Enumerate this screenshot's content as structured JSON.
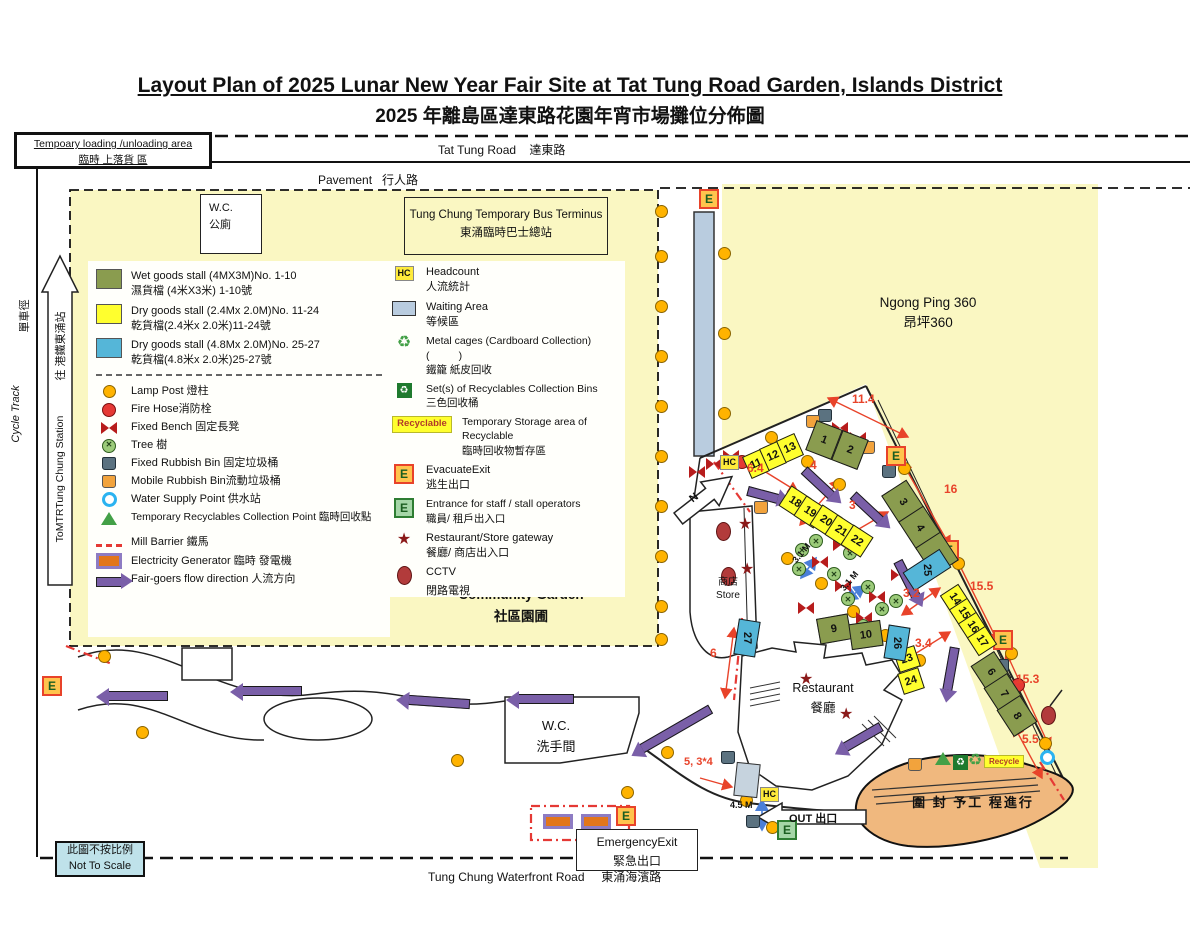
{
  "title": {
    "en": "Layout Plan of 2025 Lunar New Year Fair Site at Tat Tung Road Garden, Islands District",
    "zh": "2025 年離島區達東路花園年宵市場攤位分佈圖"
  },
  "roads": {
    "tat_tung_en": "Tat Tung Road",
    "tat_tung_zh": "達東路",
    "pavement_en": "Pavement",
    "pavement_zh": "行人路",
    "waterfront_en": "Tung Chung Waterfront Road",
    "waterfront_zh": "東涌海濱路"
  },
  "areas": {
    "loading_en": "Tempoary loading /unloading area",
    "loading_zh": "臨時 上落貨 區",
    "wc_top_en": "W.C.",
    "wc_top_zh": "公廁",
    "bus_en": "Tung Chung Temporary Bus Terminus",
    "bus_zh": "東涌臨時巴士總站",
    "ngong_en": "Ngong Ping 360",
    "ngong_zh": "昂坪360",
    "community_en": "Community Garden",
    "community_zh": "社區園圃",
    "wc_bottom_en": "W.C.",
    "wc_bottom_zh": "洗手間",
    "restaurant_en": "Restaurant",
    "restaurant_zh": "餐廳",
    "store_zh": "商店",
    "store_en": "Store",
    "emergency_en": "EmergencyExit",
    "emergency_zh": "緊急出口",
    "not_scale_zh": "此圖不按比例",
    "not_scale_en": "Not To Scale",
    "works_zh": "圍 封 予工 程進行",
    "cycle_en": "Cycle Track",
    "cycle_zh": "單車徑",
    "mtr_zh": "往 港鐵東涌站",
    "mtr_en": "ToMTRTung Chung Station"
  },
  "markers": {
    "hc": "HC",
    "e": "E",
    "out": "OUT 出口",
    "north": "N",
    "recyclable": "Recyclable",
    "recycle": "Recycle"
  },
  "legend_left": {
    "stall_types": [
      {
        "en": "Wet goods stall (4MX3M)No. 1-10",
        "zh": "濕貨檔 (4米X3米) 1-10號"
      },
      {
        "en": "Dry goods stall (2.4Mx 2.0M)No. 11-24",
        "zh": "乾貨檔(2.4米x 2.0米)11-24號"
      },
      {
        "en": "Dry goods stall (4.8Mx 2.0M)No. 25-27",
        "zh": "乾貨檔(4.8米x 2.0米)25-27號"
      }
    ],
    "items": [
      {
        "label": "Lamp Post 燈柱"
      },
      {
        "label": "Fire Hose消防栓"
      },
      {
        "label": "Fixed Bench 固定長凳"
      },
      {
        "label": "Tree 樹"
      },
      {
        "label": "Fixed Rubbish Bin 固定垃圾桶"
      },
      {
        "label": "Mobile Rubbish Bin流動垃圾桶"
      },
      {
        "label": "Water Supply Point 供水站"
      },
      {
        "label": "Temporary Recyclables Collection Point 臨時回收點"
      },
      {
        "label": "Mill Barrier  鐵馬"
      },
      {
        "label": "Electricity Generator 臨時 發電機"
      },
      {
        "label": "Fair-goers flow direction  人流方向"
      }
    ]
  },
  "legend_mid": {
    "paren": "(          )",
    "items": [
      {
        "en": "Headcount",
        "zh": "人流統計"
      },
      {
        "en": "Waiting Area",
        "zh": "等候區"
      },
      {
        "en": "Metal cages (Cardboard Collection)",
        "zh": "鐵籠 紙皮回收"
      },
      {
        "en": "Set(s) of Recyclables Collection Bins",
        "zh": "三色回收桶"
      },
      {
        "en": "Temporary Storage area of Recyclable",
        "zh": "臨時回收物暫存區"
      },
      {
        "en": "EvacuateExit",
        "zh": "逃生出口"
      },
      {
        "en": "Entrance for staff / stall operators",
        "zh": "職員/ 租戶出入口"
      },
      {
        "en": "Restaurant/Store gateway",
        "zh": "餐廳/ 商店出入口"
      },
      {
        "en": "CCTV",
        "zh": "閉路電視"
      }
    ]
  },
  "stalls": [
    "1",
    "2",
    "3",
    "4",
    "5",
    "6",
    "7",
    "8",
    "9",
    "10",
    "11",
    "12",
    "13",
    "14",
    "15",
    "16",
    "17",
    "18",
    "19",
    "20",
    "21",
    "22",
    "23",
    "24",
    "25",
    "26",
    "27"
  ],
  "red_dims": [
    "11.4",
    "6.4",
    "4",
    "3",
    "16",
    "3.2",
    "15.5",
    "3.4",
    "15.3",
    "5.5",
    "6",
    "5, 3*4"
  ],
  "blue_dims": [
    "3.1 M",
    "3.1 M",
    "4.5 M"
  ]
}
